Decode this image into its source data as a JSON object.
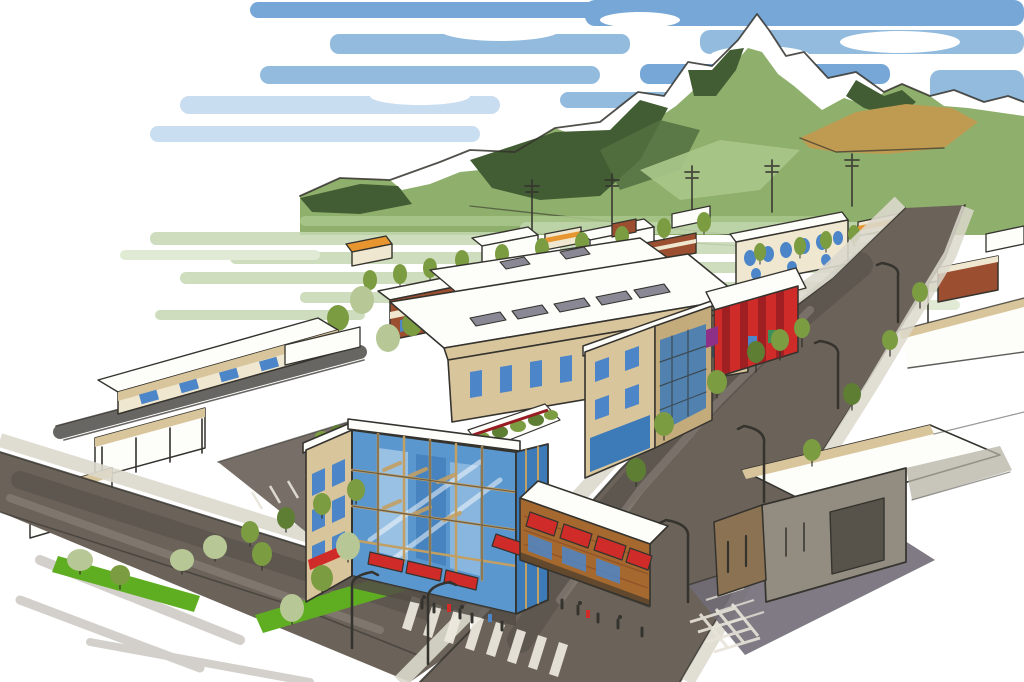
{
  "image": {
    "type": "architectural-concept-rendering",
    "medium": "hand-drawn marker and watercolor aerial sketch",
    "description": "Aerial artist's rendering of a proposed downtown mixed-use development: a four-story building with a blue glass corner tower, tan upper floors, rooftop terraces, and a one-story brick retail wing with red awnings; tree-lined streets, crosswalks, surface parking, neighboring storefronts and a gray warehouse; a small town grid in the midground and a snow-capped, forested mountain under a blue streaked sky.",
    "visible_text": "none"
  },
  "colors": {
    "paper": "#ffffff",
    "ink": "#35332e",
    "sky": "#8db8dd",
    "skyDeep": "#6fa3d4",
    "skyPale": "#c6dcef",
    "snow": "#ffffff",
    "slope": "#8fb06c",
    "slopeLight": "#aac78b",
    "forest": "#52703f",
    "forestDark": "#425d33",
    "valley": "#c5d8b2",
    "valleyLight": "#dbe7cd",
    "field": "#bf9b52",
    "roofWhite": "#fdfdfa",
    "tan": "#d9c59c",
    "tanDark": "#c4ab7c",
    "cream": "#efe7cf",
    "brick": "#9c4f30",
    "retailBrick": "#a5692f",
    "brickDark": "#7e3a22",
    "red": "#cf2b28",
    "redDark": "#971d22",
    "orange": "#e6952f",
    "glass": "#5b97cf",
    "glassDark": "#3d7ab8",
    "glassLight": "#a9cce8",
    "windowBlue": "#4d86c8",
    "mullion": "#c29f63",
    "unitGray": "#8b8896",
    "street": "#6b635a",
    "streetDark": "#524c45",
    "streetPale": "#938c81",
    "apron": "#716b76",
    "sidewalk": "#dcd8cc",
    "lawn": "#5fae22",
    "treeOlive": "#7c9c42",
    "treeDark": "#5d7e33",
    "treeSage": "#b7c795",
    "warehouse": "#928d80",
    "warehouseDark": "#57534a",
    "purple": "#8e3087"
  },
  "scene": {
    "background": [
      "streaked-blue-sky",
      "snow-capped-mountain",
      "forest-patches",
      "tan-hillside-field",
      "green-valley-washes"
    ],
    "midground": [
      "small-town-buildings",
      "street-trees",
      "utility-poles"
    ],
    "site": {
      "main_building": [
        "long-mixed-use-block",
        "glass-corner-tower",
        "east-wing",
        "rooftop-terraces",
        "brick-retail-wing",
        "red-awnings",
        "pedestrians"
      ],
      "streets": [
        "main-avenue",
        "cross-street",
        "ladder-crosswalk",
        "hatched-crosswalk",
        "street-lamps",
        "surface-parking-lot",
        "lawn-strips",
        "sidewalks"
      ],
      "neighbors": [
        "red-storefront-building",
        "gray-warehouse",
        "low-tan-buildings",
        "brick-buildings"
      ]
    }
  }
}
